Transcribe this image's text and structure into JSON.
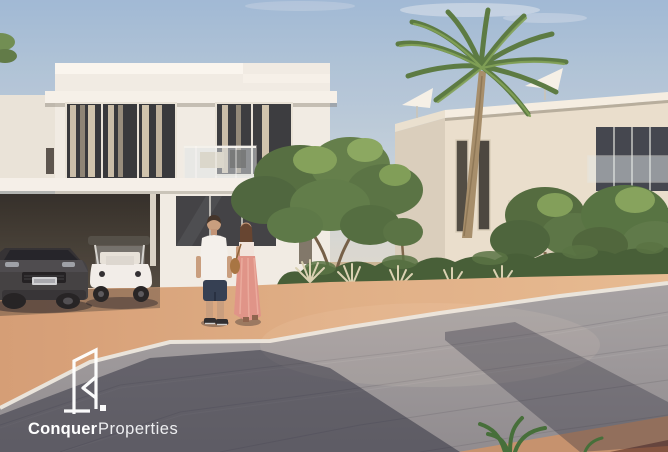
{
  "canvas": {
    "width": 668,
    "height": 452
  },
  "watermark": {
    "brand": "Conquer",
    "suffix": "Properties"
  },
  "scene": {
    "type": "architectural-rendering",
    "alt": "Two modern white villas with a tall palm tree, trees and hedges; a couple walks along a salmon-coloured footpath beside a grey block-paved road; a dark SUV and a white golf buggy are parked by the left villa's carport; white parasols on the far roof terrace.",
    "palette": {
      "sky_top": "#9db9d8",
      "sky_horizon": "#e8decb",
      "villa_white": "#f1eee7",
      "villa_beige": "#e9e0cf",
      "foliage": "#537041",
      "palm_trunk": "#a38c69",
      "road_paver": "#98969a",
      "footpath": "#dcab83",
      "curb": "#e9e6df",
      "shadow": "#1c2032",
      "suv": "#3b3b3f",
      "golf_cart": "#f2f0ec",
      "shirt": "#f4f3f0",
      "dress": "#df9287",
      "logo": "#ffffff"
    }
  }
}
